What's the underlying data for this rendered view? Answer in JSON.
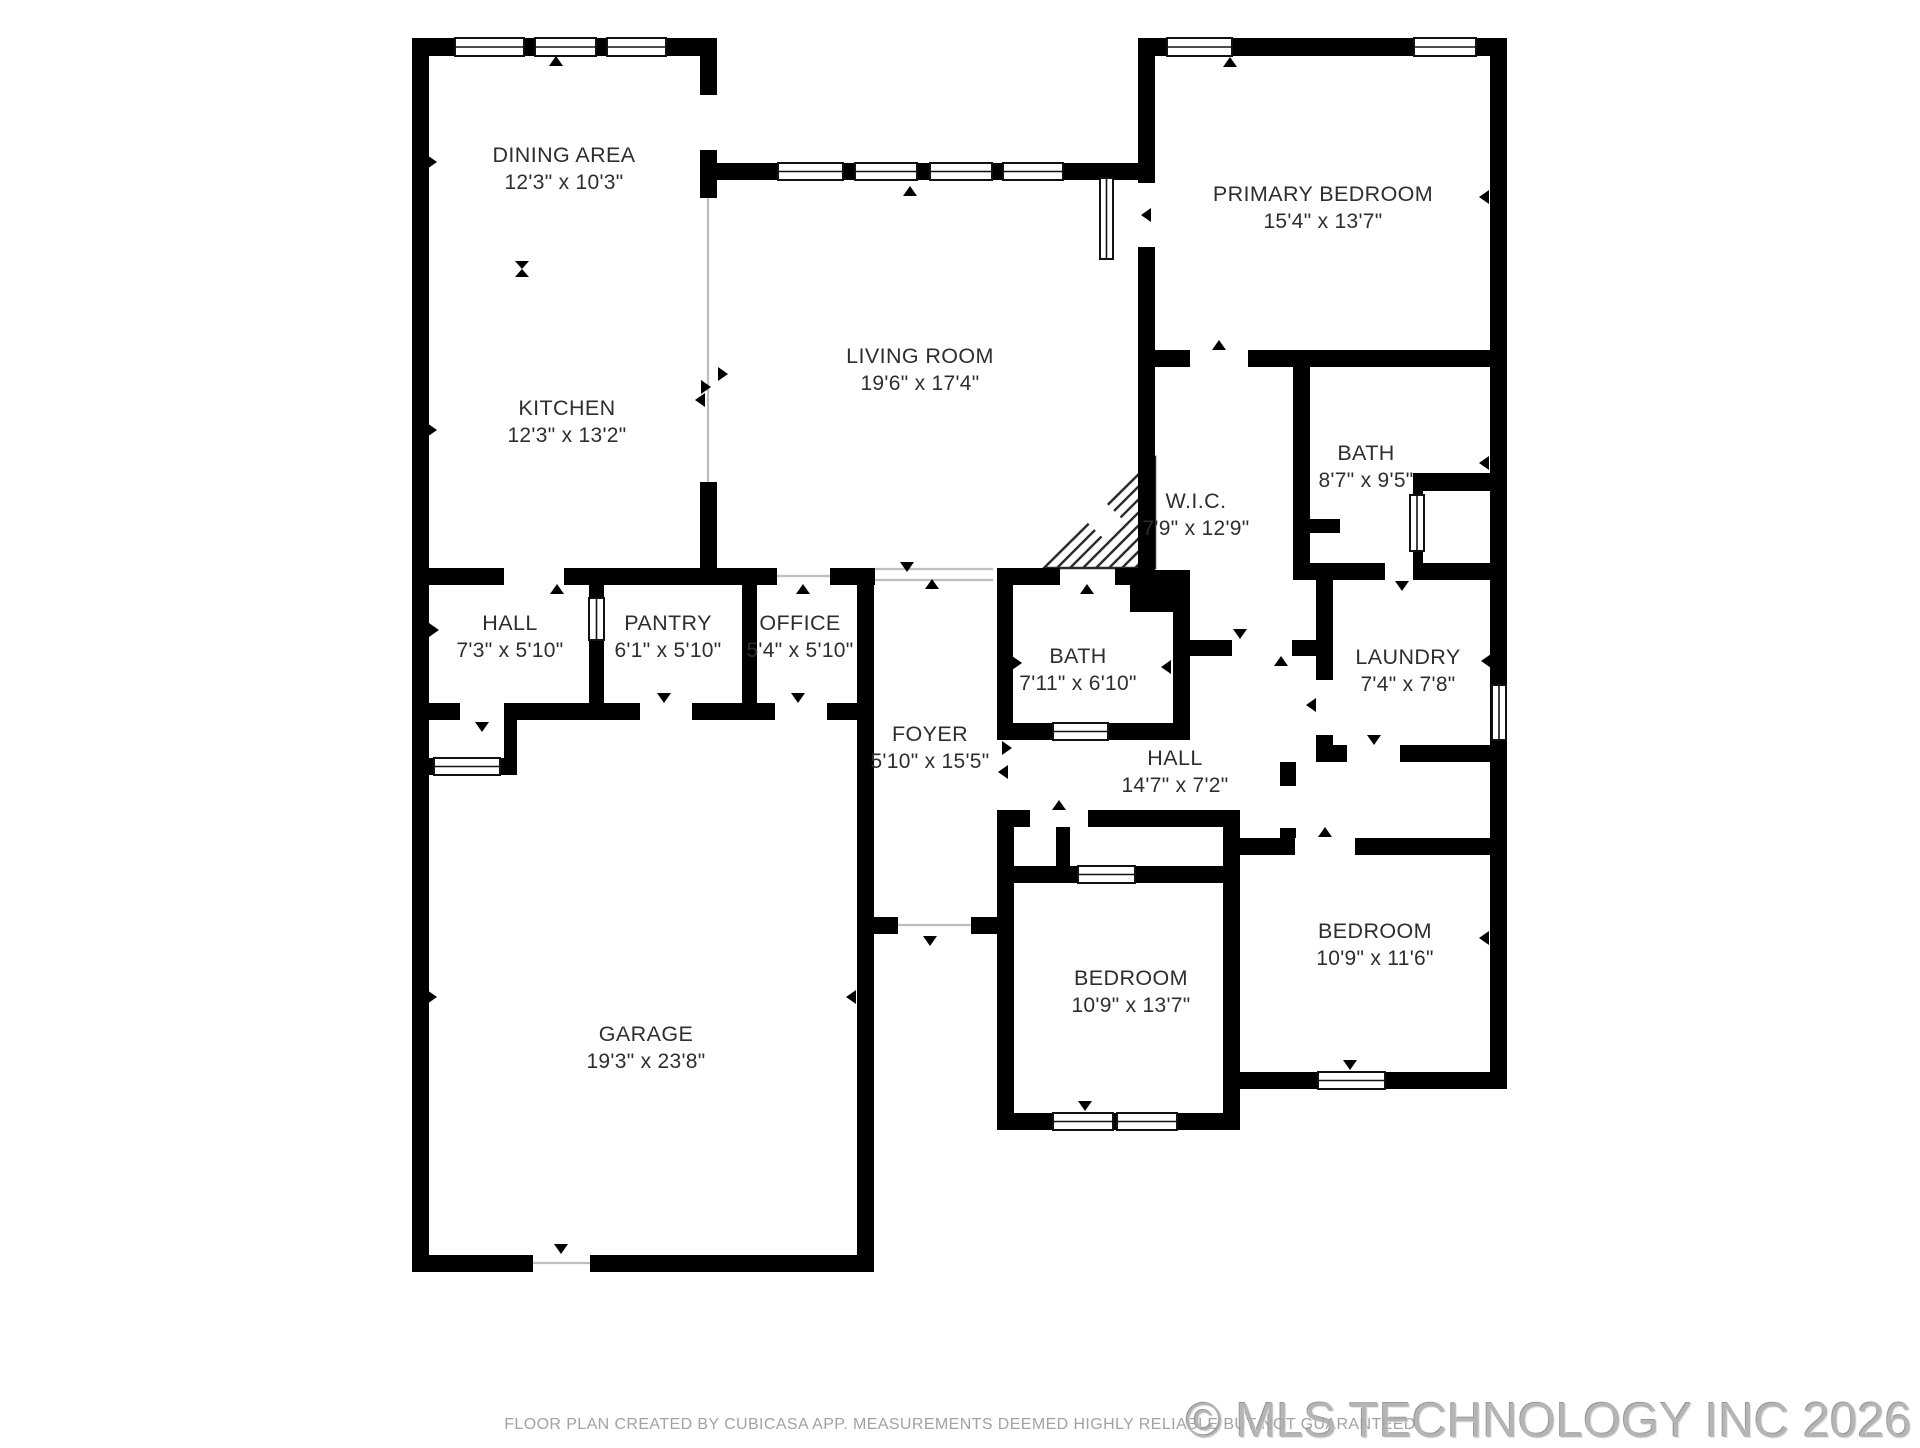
{
  "floorplan": {
    "width": 1920,
    "height": 1440,
    "colors": {
      "wall": "#000000",
      "label": "#2e2e2e",
      "window_fill": "#ffffff",
      "window_frame": "#111111",
      "open_line": "#bdbdbd",
      "hatch_line": "#2b2b2b"
    },
    "rooms": [
      {
        "id": "dining",
        "name": "DINING AREA",
        "dims": "12'3\" x 10'3\"",
        "x": 564,
        "y": 162
      },
      {
        "id": "kitchen",
        "name": "KITCHEN",
        "dims": "12'3\" x 13'2\"",
        "x": 567,
        "y": 415
      },
      {
        "id": "living",
        "name": "LIVING ROOM",
        "dims": "19'6\" x 17'4\"",
        "x": 920,
        "y": 363
      },
      {
        "id": "primary-bedroom",
        "name": "PRIMARY BEDROOM",
        "dims": "15'4\" x 13'7\"",
        "x": 1323,
        "y": 201
      },
      {
        "id": "bath-primary",
        "name": "BATH",
        "dims": "8'7\" x 9'5\"",
        "x": 1366,
        "y": 460
      },
      {
        "id": "wic",
        "name": "W.I.C.",
        "dims": "7'9\" x 12'9\"",
        "x": 1196,
        "y": 508
      },
      {
        "id": "hall-upper",
        "name": "HALL",
        "dims": "7'3\" x 5'10\"",
        "x": 510,
        "y": 630
      },
      {
        "id": "pantry",
        "name": "PANTRY",
        "dims": "6'1\" x 5'10\"",
        "x": 668,
        "y": 630
      },
      {
        "id": "office",
        "name": "OFFICE",
        "dims": "5'4\" x 5'10\"",
        "x": 800,
        "y": 630
      },
      {
        "id": "bath-hall",
        "name": "BATH",
        "dims": "7'11\" x 6'10\"",
        "x": 1078,
        "y": 663
      },
      {
        "id": "laundry",
        "name": "LAUNDRY",
        "dims": "7'4\" x 7'8\"",
        "x": 1408,
        "y": 664
      },
      {
        "id": "foyer",
        "name": "FOYER",
        "dims": "5'10\" x 15'5\"",
        "x": 930,
        "y": 741
      },
      {
        "id": "hall-lower",
        "name": "HALL",
        "dims": "14'7\" x 7'2\"",
        "x": 1175,
        "y": 765
      },
      {
        "id": "garage",
        "name": "GARAGE",
        "dims": "19'3\" x 23'8\"",
        "x": 646,
        "y": 1041
      },
      {
        "id": "bedroom-mid",
        "name": "BEDROOM",
        "dims": "10'9\" x 13'7\"",
        "x": 1131,
        "y": 985
      },
      {
        "id": "bedroom-right",
        "name": "BEDROOM",
        "dims": "10'9\" x 11'6\"",
        "x": 1375,
        "y": 938
      }
    ],
    "walls": [
      [
        412,
        38,
        17,
        1234
      ],
      [
        412,
        38,
        305,
        18
      ],
      [
        1138,
        38,
        369,
        18
      ],
      [
        1490,
        38,
        17,
        1051
      ],
      [
        700,
        38,
        17,
        57
      ],
      [
        700,
        150,
        17,
        48
      ],
      [
        700,
        482,
        17,
        103
      ],
      [
        700,
        163,
        455,
        17
      ],
      [
        1138,
        38,
        17,
        145
      ],
      [
        1138,
        247,
        17,
        120
      ],
      [
        1155,
        350,
        35,
        17
      ],
      [
        1248,
        350,
        259,
        17
      ],
      [
        1138,
        367,
        17,
        203
      ],
      [
        1130,
        570,
        60,
        42
      ],
      [
        1293,
        367,
        17,
        196
      ],
      [
        1293,
        519,
        47,
        14
      ],
      [
        1293,
        563,
        92,
        17
      ],
      [
        1417,
        563,
        75,
        17
      ],
      [
        1417,
        473,
        75,
        18
      ],
      [
        1413,
        473,
        10,
        24
      ],
      [
        1413,
        549,
        10,
        31
      ],
      [
        1316,
        580,
        17,
        100
      ],
      [
        1316,
        735,
        17,
        27
      ],
      [
        1333,
        745,
        14,
        17
      ],
      [
        1400,
        745,
        90,
        17
      ],
      [
        1190,
        640,
        42,
        16
      ],
      [
        1292,
        640,
        41,
        16
      ],
      [
        997,
        568,
        63,
        17
      ],
      [
        1115,
        568,
        40,
        17
      ],
      [
        997,
        585,
        16,
        155
      ],
      [
        1173,
        612,
        17,
        128
      ],
      [
        997,
        723,
        56,
        17
      ],
      [
        1108,
        723,
        82,
        17
      ],
      [
        429,
        568,
        75,
        17
      ],
      [
        564,
        568,
        153,
        17
      ],
      [
        717,
        568,
        60,
        17
      ],
      [
        830,
        568,
        45,
        17
      ],
      [
        589,
        585,
        15,
        13
      ],
      [
        589,
        640,
        15,
        63
      ],
      [
        742,
        585,
        15,
        118
      ],
      [
        429,
        703,
        31,
        17
      ],
      [
        504,
        703,
        136,
        17
      ],
      [
        692,
        703,
        83,
        17
      ],
      [
        827,
        703,
        45,
        17
      ],
      [
        857,
        585,
        17,
        687
      ],
      [
        504,
        720,
        13,
        55
      ],
      [
        412,
        758,
        105,
        17
      ],
      [
        874,
        917,
        24,
        17
      ],
      [
        971,
        917,
        42,
        17
      ],
      [
        997,
        810,
        17,
        320
      ],
      [
        1013,
        810,
        17,
        17
      ],
      [
        1088,
        810,
        152,
        17
      ],
      [
        1013,
        866,
        65,
        17
      ],
      [
        1135,
        866,
        105,
        17
      ],
      [
        1056,
        827,
        14,
        39
      ],
      [
        1223,
        810,
        17,
        320
      ],
      [
        1240,
        838,
        55,
        17
      ],
      [
        1355,
        838,
        135,
        17
      ],
      [
        1280,
        762,
        16,
        24
      ],
      [
        1280,
        828,
        16,
        10
      ],
      [
        997,
        1113,
        243,
        17
      ],
      [
        1240,
        1072,
        267,
        17
      ],
      [
        412,
        1255,
        121,
        17
      ],
      [
        590,
        1255,
        284,
        17
      ]
    ],
    "windows": [
      [
        455,
        38,
        69,
        18,
        "h"
      ],
      [
        535,
        38,
        61,
        18,
        "h"
      ],
      [
        607,
        38,
        59,
        18,
        "h"
      ],
      [
        778,
        163,
        65,
        17,
        "h"
      ],
      [
        855,
        163,
        62,
        17,
        "h"
      ],
      [
        930,
        163,
        62,
        17,
        "h"
      ],
      [
        1003,
        163,
        60,
        17,
        "h"
      ],
      [
        1167,
        38,
        65,
        18,
        "h"
      ],
      [
        1414,
        38,
        62,
        18,
        "h"
      ],
      [
        1492,
        685,
        14,
        55,
        "v"
      ],
      [
        1053,
        1113,
        60,
        17,
        "h"
      ],
      [
        1117,
        1113,
        60,
        17,
        "h"
      ],
      [
        1318,
        1072,
        67,
        17,
        "h"
      ],
      [
        434,
        758,
        66,
        17,
        "h"
      ],
      [
        1078,
        866,
        57,
        17,
        "h"
      ],
      [
        1100,
        178,
        13,
        81,
        "v"
      ],
      [
        1410,
        495,
        14,
        56,
        "v"
      ],
      [
        1053,
        723,
        55,
        17,
        "h"
      ],
      [
        589,
        598,
        15,
        42,
        "v"
      ]
    ],
    "arrows": [
      [
        557,
        589,
        "up"
      ],
      [
        803,
        589,
        "up"
      ],
      [
        907,
        567,
        "down"
      ],
      [
        932,
        584,
        "up"
      ],
      [
        1087,
        589,
        "up"
      ],
      [
        1219,
        345,
        "up"
      ],
      [
        1146,
        215,
        "left"
      ],
      [
        1402,
        586,
        "down"
      ],
      [
        1240,
        634,
        "down"
      ],
      [
        1281,
        661,
        "up"
      ],
      [
        1311,
        705,
        "left"
      ],
      [
        1374,
        740,
        "down"
      ],
      [
        1325,
        832,
        "up"
      ],
      [
        1059,
        805,
        "up"
      ],
      [
        482,
        727,
        "down"
      ],
      [
        664,
        698,
        "down"
      ],
      [
        798,
        698,
        "down"
      ],
      [
        930,
        941,
        "down"
      ],
      [
        561,
        1249,
        "down"
      ],
      [
        910,
        191,
        "up"
      ],
      [
        556,
        61,
        "up"
      ],
      [
        1230,
        62,
        "up"
      ],
      [
        1085,
        1106,
        "down"
      ],
      [
        1350,
        1065,
        "down"
      ],
      [
        432,
        162,
        "right"
      ],
      [
        432,
        430,
        "right"
      ],
      [
        432,
        997,
        "right"
      ],
      [
        1484,
        197,
        "left"
      ],
      [
        1484,
        463,
        "left"
      ],
      [
        1486,
        661,
        "left"
      ],
      [
        1484,
        938,
        "left"
      ],
      [
        851,
        997,
        "left"
      ],
      [
        1017,
        663,
        "right"
      ],
      [
        1166,
        667,
        "left"
      ],
      [
        869,
        748,
        "left"
      ],
      [
        1007,
        748,
        "right"
      ],
      [
        1003,
        772,
        "left"
      ],
      [
        706,
        387,
        "right"
      ],
      [
        700,
        400,
        "left"
      ],
      [
        434,
        630,
        "right"
      ],
      [
        723,
        374,
        "right"
      ],
      [
        1150,
        520,
        "right"
      ]
    ],
    "open_lines": [
      [
        708,
        198,
        708,
        482
      ],
      [
        875,
        569,
        993,
        569
      ],
      [
        875,
        580,
        993,
        580
      ],
      [
        898,
        925,
        971,
        925
      ],
      [
        533,
        1263,
        590,
        1263
      ],
      [
        777,
        576,
        830,
        576
      ]
    ],
    "hatch": {
      "triangle": [
        [
          1044,
          568
        ],
        [
          1155,
          458
        ],
        [
          1155,
          568
        ]
      ],
      "diamond": [
        [
          1103,
          500
        ],
        [
          1122,
          519
        ],
        [
          1103,
          538
        ],
        [
          1084,
          519
        ]
      ],
      "spacing": 13
    },
    "center_marker": {
      "x": 522,
      "y": 269
    }
  },
  "footer": {
    "disclaimer": "FLOOR PLAN CREATED BY CUBICASA APP. MEASUREMENTS DEEMED HIGHLY RELIABLE BUT NOT GUARANTEED",
    "watermark": "© MLS TECHNOLOGY INC 2026"
  }
}
